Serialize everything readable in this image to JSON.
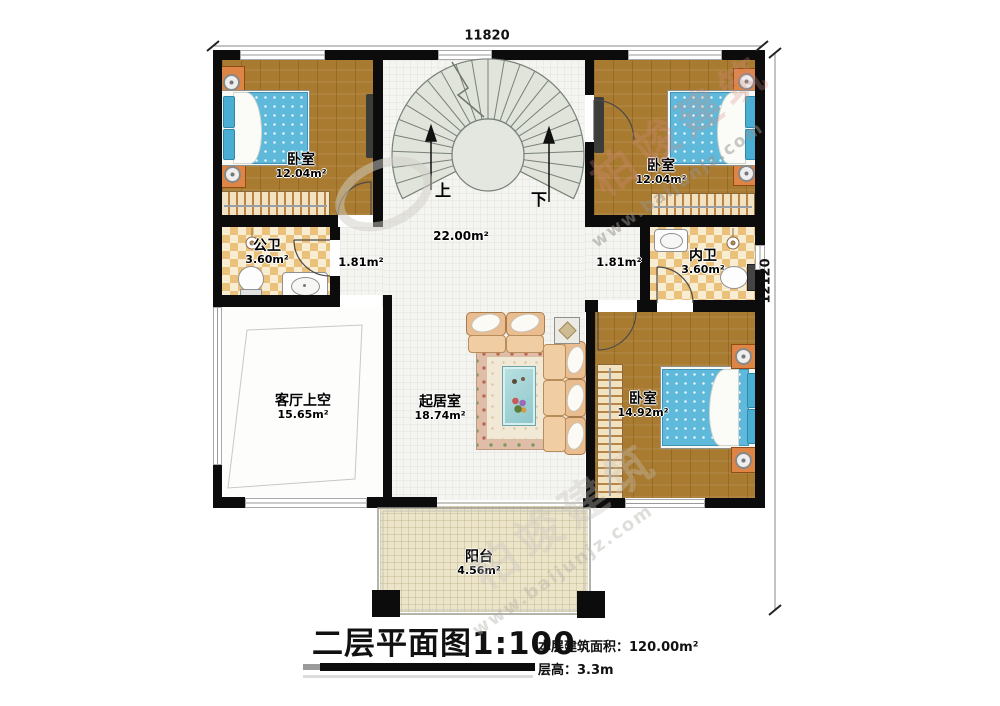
{
  "dimensions": {
    "top": "11820",
    "right": "12120"
  },
  "stairwell": {
    "up_label": "上",
    "down_label": "下"
  },
  "areas": {
    "hall": "22.00m²",
    "corridor_left": "1.81m²",
    "corridor_right": "1.81m²"
  },
  "rooms": {
    "bedroom_top_left": {
      "name": "卧室",
      "area": "12.04m²"
    },
    "bedroom_top_right": {
      "name": "卧室",
      "area": "12.04m²"
    },
    "bedroom_bottom_right": {
      "name": "卧室",
      "area": "14.92m²"
    },
    "public_bathroom": {
      "name": "公卫",
      "area": "3.60m²"
    },
    "private_bathroom": {
      "name": "内卫",
      "area": "3.60m²"
    },
    "living_void": {
      "name": "客厅上空",
      "area": "15.65m²"
    },
    "living_room": {
      "name": "起居室",
      "area": "18.74m²"
    },
    "balcony": {
      "name": "阳台",
      "area": "4.56m²"
    }
  },
  "title_block": {
    "title": "二层平面图1:100",
    "floor_area": "本层建筑面积：120.00m²",
    "floor_height": "层高：3.3m"
  },
  "watermark": {
    "brand": "柏竣建筑",
    "site": "www.baijunjz.com"
  }
}
